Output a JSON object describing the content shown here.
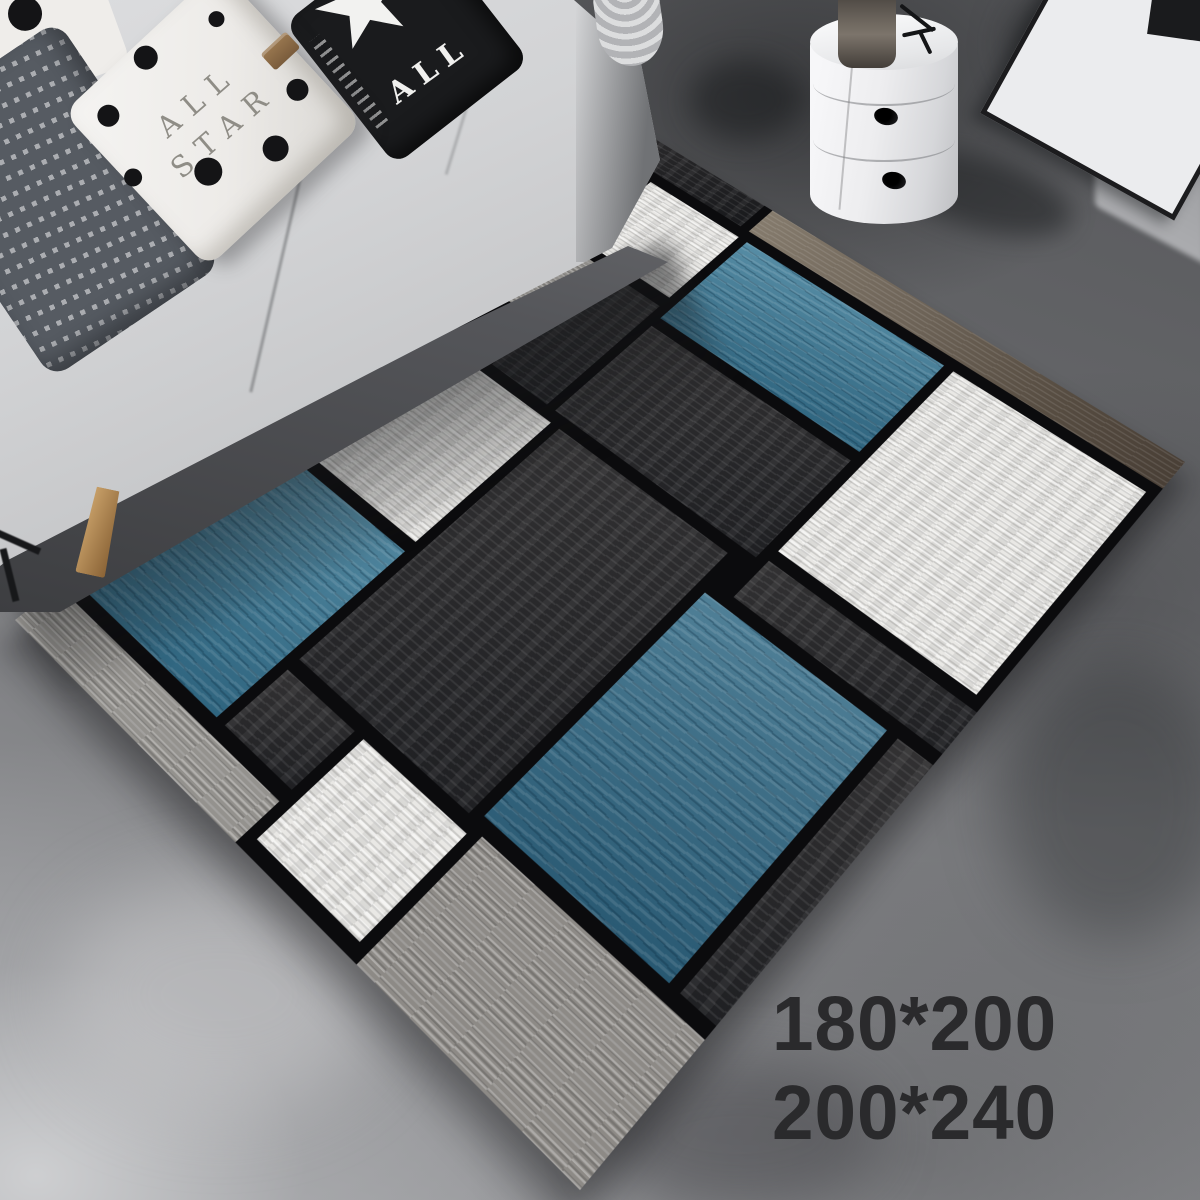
{
  "scene": {
    "description": "Product photo: geometric Mondrian-style area rug in blue, gray, charcoal and white laid at an angle on a dark concrete floor of a living room, gray sofa with pillows at top left, white drum side table with vase and leaning picture frame at top right",
    "width_px": 1200,
    "height_px": 1200
  },
  "size_overlay": {
    "lines": [
      "180*200",
      "200*240"
    ],
    "color": "#2a2a2c"
  },
  "pillows": {
    "allstar": {
      "line1": "ALL",
      "line2": "STAR",
      "tag_color": "#8a6a48"
    },
    "star_pillow": {
      "word": "ALL"
    }
  },
  "rug": {
    "palette": {
      "charcoal-dark": "#222327",
      "charcoal": "#2b2c30",
      "taupe": "#766c60",
      "white": "#e9e8e5",
      "gray": "#94928e",
      "graybig": "#8d8a86",
      "blue": "#3b7a96",
      "blue-dark": "#336b86",
      "base_lines": "#0b0b0d"
    },
    "blocks": [
      {
        "name": "band-top-dark",
        "x": 0,
        "y": 0,
        "w": 266,
        "h": 48,
        "tex": "charcoal-dark"
      },
      {
        "name": "band-top-taupe",
        "x": 282,
        "y": 0,
        "w": 718,
        "h": 48,
        "tex": "taupe"
      },
      {
        "name": "charcoal-top-left",
        "x": 0,
        "y": 64,
        "w": 82,
        "h": 136,
        "tex": "charcoal"
      },
      {
        "name": "white-square-top",
        "x": 98,
        "y": 64,
        "w": 180,
        "h": 134,
        "tex": "white"
      },
      {
        "name": "blue-rect-top",
        "x": 294,
        "y": 64,
        "w": 364,
        "h": 166,
        "tex": "blue"
      },
      {
        "name": "white-square-right",
        "x": 674,
        "y": 64,
        "w": 312,
        "h": 330,
        "tex": "white"
      },
      {
        "name": "gray-square-left",
        "x": 0,
        "y": 216,
        "w": 152,
        "h": 116,
        "tex": "gray"
      },
      {
        "name": "charcoal-mid-left",
        "x": 168,
        "y": 216,
        "w": 110,
        "h": 200,
        "tex": "charcoal"
      },
      {
        "name": "charcoal-mid",
        "x": 294,
        "y": 246,
        "w": 364,
        "h": 170,
        "tex": "charcoal"
      },
      {
        "name": "charcoal-left-edge",
        "x": 0,
        "y": 348,
        "w": 82,
        "h": 300,
        "tex": "charcoal"
      },
      {
        "name": "white-square-mid",
        "x": 98,
        "y": 432,
        "w": 206,
        "h": 216,
        "tex": "white"
      },
      {
        "name": "charcoal-center",
        "x": 320,
        "y": 432,
        "w": 306,
        "h": 396,
        "tex": "charcoal"
      },
      {
        "name": "charcoal-right-strip",
        "x": 674,
        "y": 410,
        "w": 326,
        "h": 60,
        "tex": "charcoal"
      },
      {
        "name": "blue-rect-right",
        "x": 642,
        "y": 486,
        "w": 290,
        "h": 334,
        "tex": "blue-dark"
      },
      {
        "name": "charcoal-right-edge",
        "x": 948,
        "y": 486,
        "w": 52,
        "h": 334,
        "tex": "charcoal"
      },
      {
        "name": "blue-square-left",
        "x": 0,
        "y": 664,
        "w": 304,
        "h": 264,
        "tex": "blue"
      },
      {
        "name": "charcoal-bottom-small",
        "x": 320,
        "y": 844,
        "w": 126,
        "h": 84,
        "tex": "charcoal"
      },
      {
        "name": "white-square-bottom",
        "x": 462,
        "y": 844,
        "w": 180,
        "h": 140,
        "tex": "white"
      },
      {
        "name": "gray-band-bottom",
        "x": 0,
        "y": 944,
        "w": 446,
        "h": 56,
        "tex": "gray"
      },
      {
        "name": "gray-bottom-corner",
        "x": 658,
        "y": 836,
        "w": 342,
        "h": 164,
        "tex": "graybig"
      }
    ]
  }
}
